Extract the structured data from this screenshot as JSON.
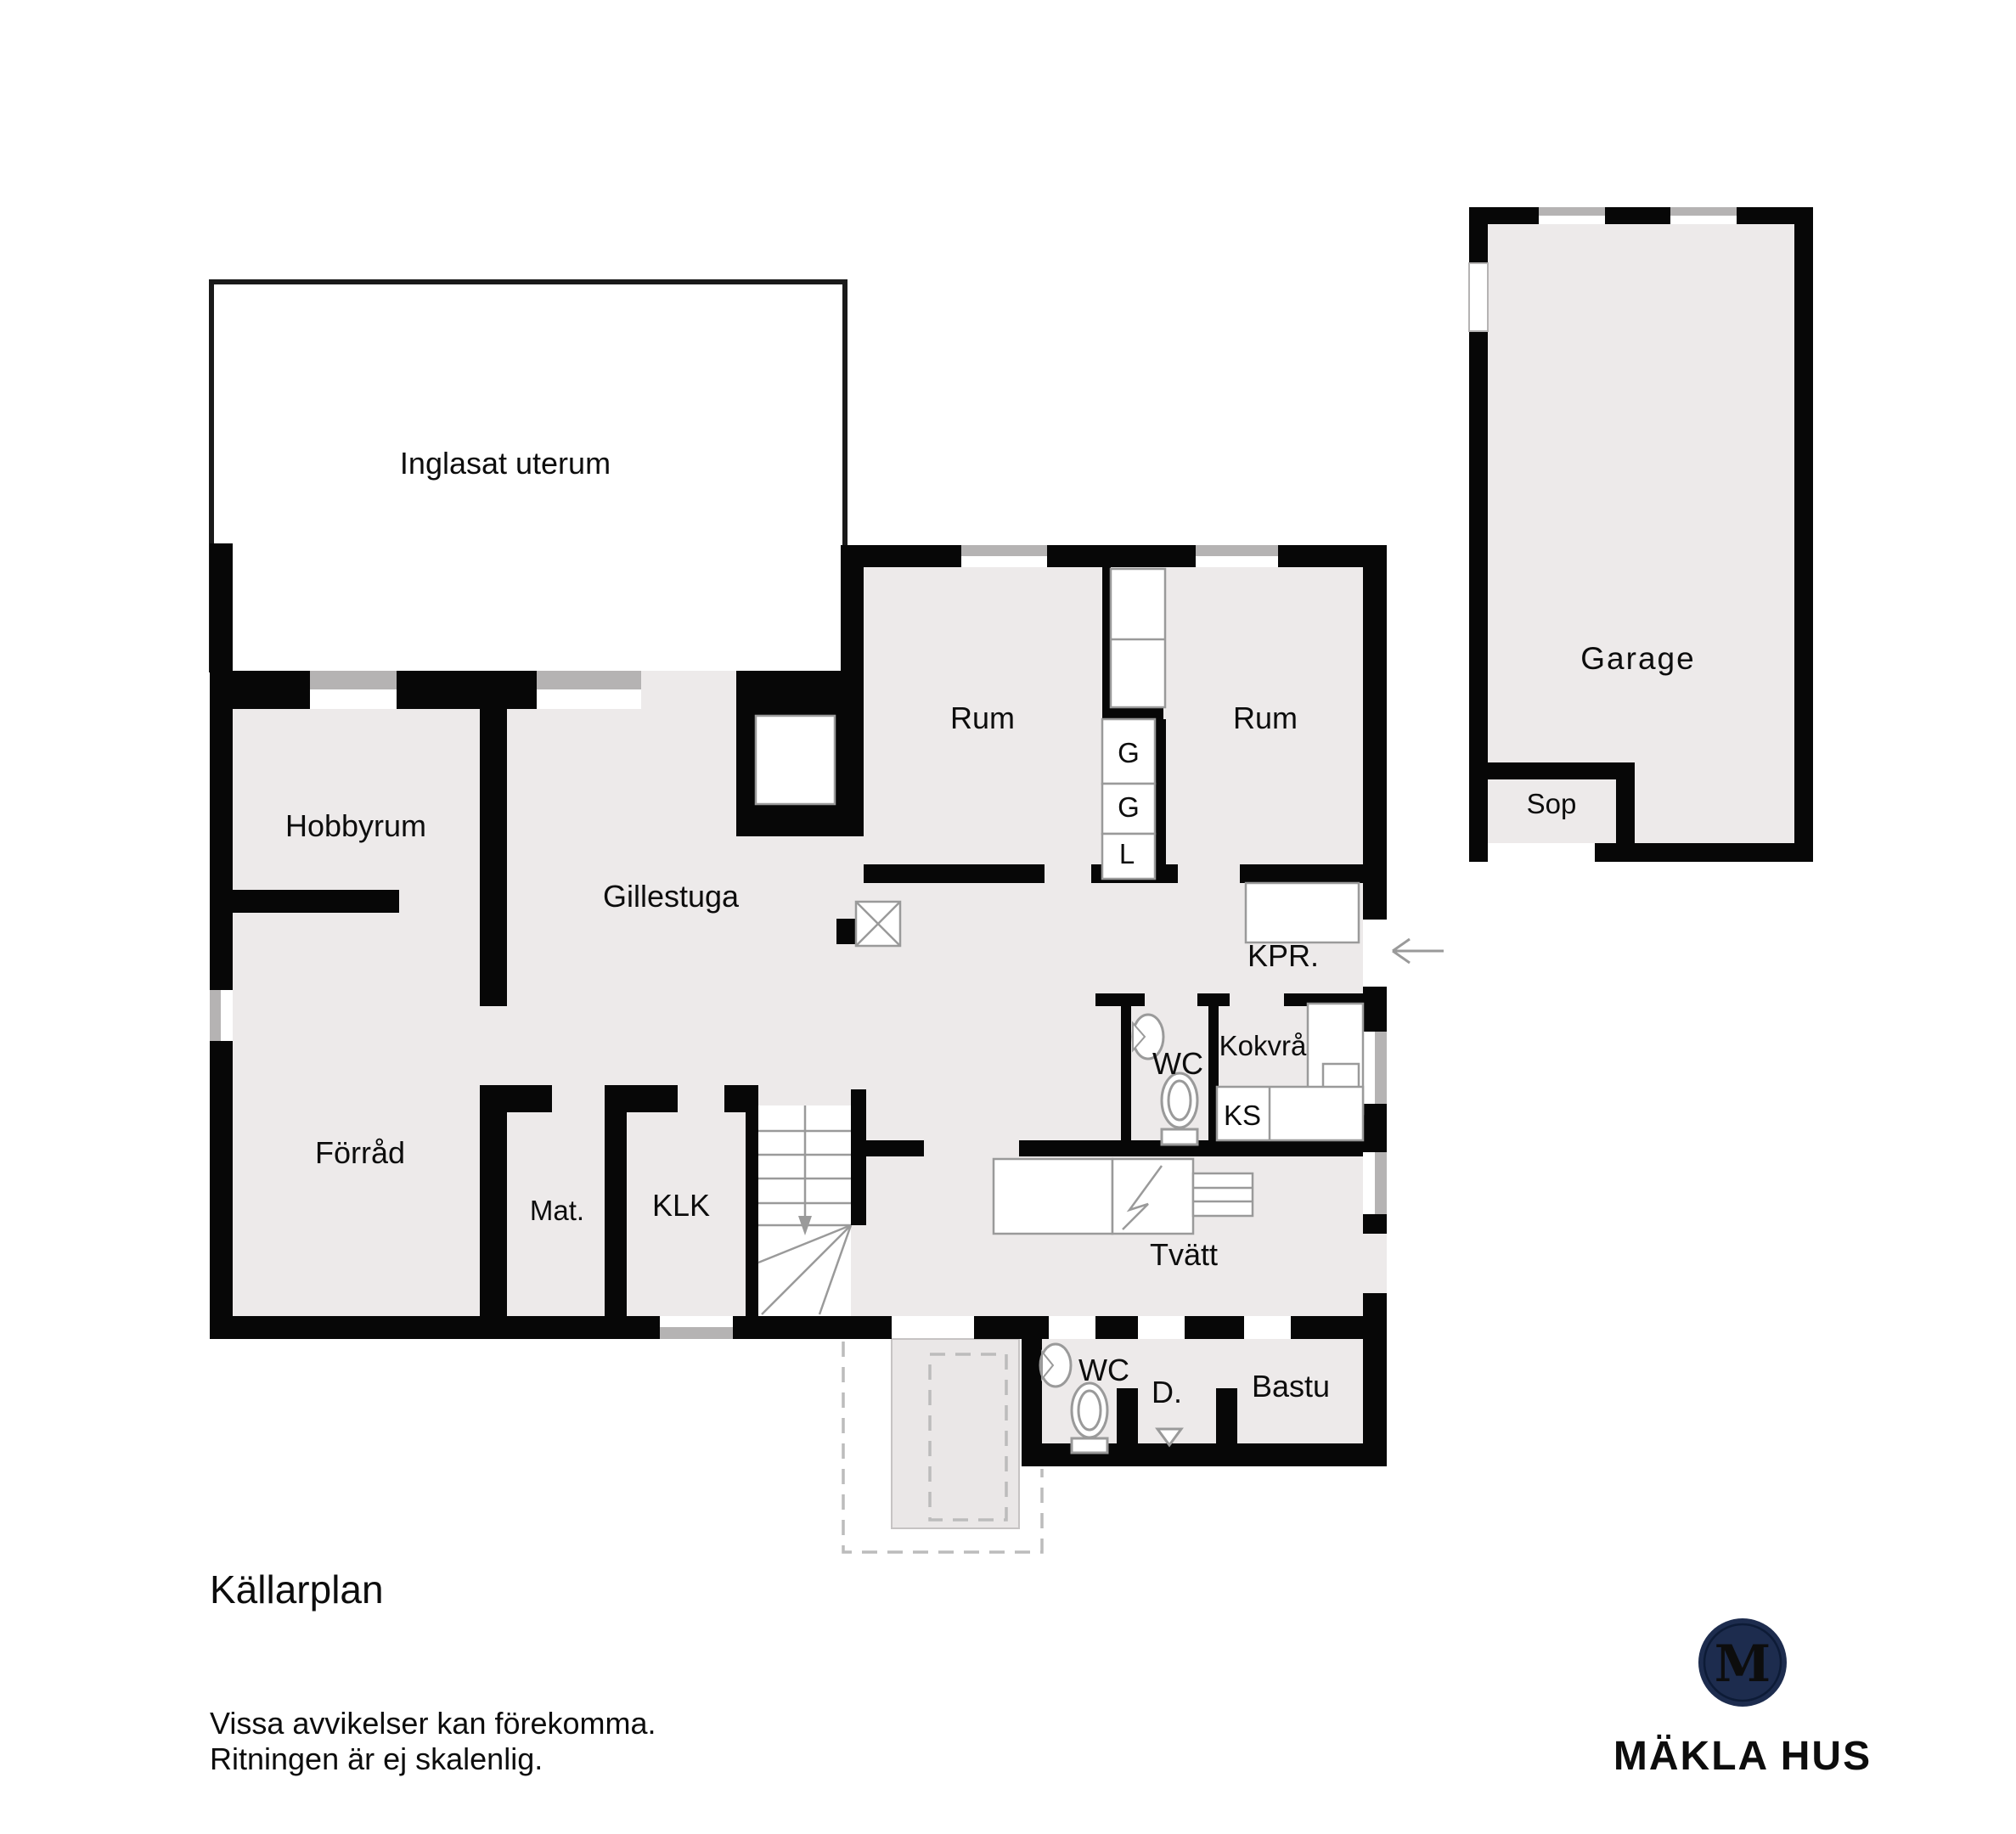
{
  "meta": {
    "floor_title": "Källarplan",
    "disclaimer1": "Vissa avvikelser kan förekomma.",
    "disclaimer2": "Ritningen är ej skalenlig."
  },
  "rooms": {
    "uterum": "Inglasat uterum",
    "hobbyrum": "Hobbyrum",
    "gillestuga": "Gillestuga",
    "rum_left": "Rum",
    "rum_right": "Rum",
    "kpr": "KPR.",
    "wc_upper": "WC",
    "kokvra": "Kokvrå",
    "ks": "KS",
    "forrad": "Förråd",
    "mat": "Mat.",
    "klk": "KLK",
    "tvatt": "Tvätt",
    "wc_lower": "WC",
    "dusch": "D.",
    "bastu": "Bastu",
    "garage": "Garage",
    "sop": "Sop"
  },
  "closets": {
    "g1": "G",
    "g2": "G",
    "l": "L"
  },
  "logo": {
    "brand": "MÄKLA HUS",
    "monogram": "M"
  },
  "colors": {
    "wall": "#070707",
    "floor": "#edeaea",
    "floor_exterior": "#eae7e7",
    "window_gray": "#b5b3b3",
    "outline_gray": "#9a9a9a",
    "dashed_gray": "#bcbcbc",
    "thin_border": "#1a1a1a",
    "logo_navy": "#1d2c4e",
    "logo_blue": "#5fa8dc",
    "label_text": "#0d0d0d"
  }
}
